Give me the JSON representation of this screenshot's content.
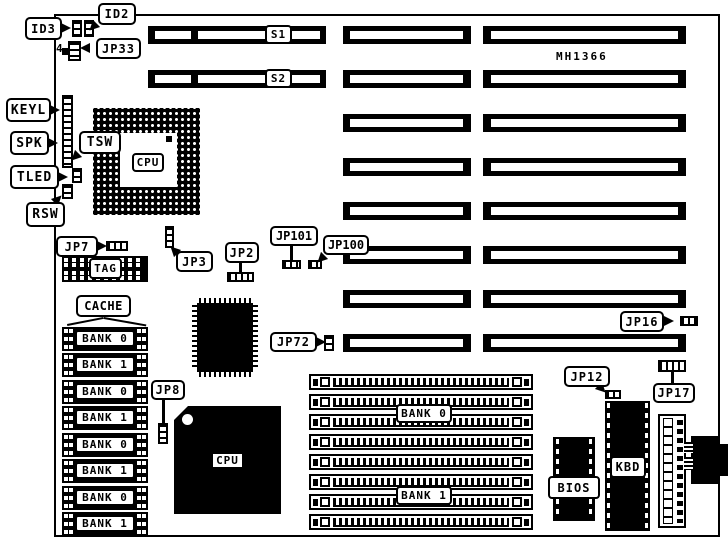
{
  "board": {
    "model_text": "MH1366"
  },
  "slots": {
    "s1": "S1",
    "s2": "S2"
  },
  "chips": {
    "cpu_socket": "CPU",
    "cpu_qfp": "CPU",
    "tag": "TAG",
    "bios": "BIOS",
    "kbd": "KBD"
  },
  "callouts": {
    "id2": "ID2",
    "id3": "ID3",
    "jp33": "JP33",
    "jp33_pin": "4",
    "keyl": "KEYL",
    "spk": "SPK",
    "tsw": "TSW",
    "tled": "TLED",
    "rsw": "RSW",
    "jp7": "JP7",
    "jp3": "JP3",
    "jp2": "JP2",
    "jp101": "JP101",
    "jp100": "JP100",
    "jp72": "JP72",
    "jp8": "JP8",
    "jp16": "JP16",
    "jp12": "JP12",
    "jp17": "JP17",
    "cache": "CACHE"
  },
  "cache_banks": [
    "BANK 0",
    "BANK 1",
    "BANK 0",
    "BANK 1",
    "BANK 0",
    "BANK 1",
    "BANK 0",
    "BANK 1"
  ],
  "simm": {
    "bank0": "BANK 0",
    "bank1": "BANK 1"
  }
}
